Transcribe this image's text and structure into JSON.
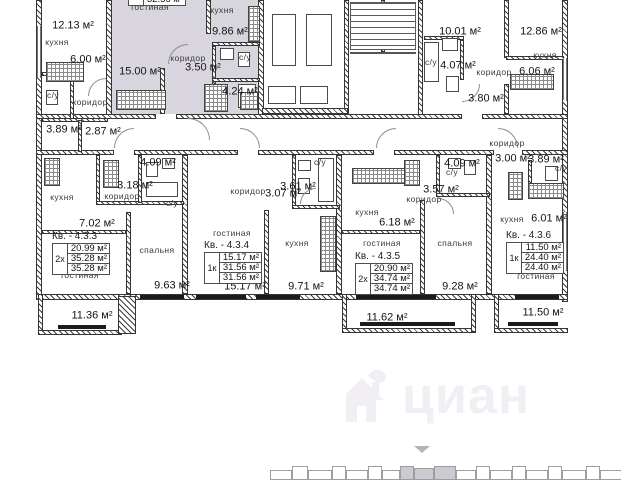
{
  "canvas": {
    "width": 621,
    "height": 480
  },
  "colors": {
    "highlight": "#d8d5de",
    "watermark": "#f1eff4",
    "wall": "#3d3d3d"
  },
  "watermark": {
    "brand": "циан"
  },
  "labels": [
    {
      "text": "12.13 м²",
      "x": 73,
      "y": 26,
      "cls": "ar"
    },
    {
      "text": "кухня",
      "x": 57,
      "y": 42,
      "cls": "rn"
    },
    {
      "text": "6.00 м²",
      "x": 88,
      "y": 60,
      "cls": "ar"
    },
    {
      "text": "с/у",
      "x": 53,
      "y": 95,
      "cls": "rn"
    },
    {
      "text": "коридор",
      "x": 90,
      "y": 102,
      "cls": "rn"
    },
    {
      "text": "3.89 м²",
      "x": 64,
      "y": 130,
      "cls": "ar"
    },
    {
      "text": "2.87 м²",
      "x": 103,
      "y": 132,
      "cls": "ar"
    },
    {
      "text": "гостиная",
      "x": 150,
      "y": 7,
      "cls": "rn"
    },
    {
      "text": "кухня",
      "x": 222,
      "y": 10,
      "cls": "rn"
    },
    {
      "text": "9.86 м²",
      "x": 230,
      "y": 32,
      "cls": "ar"
    },
    {
      "text": "с/у",
      "x": 245,
      "y": 57,
      "cls": "rn"
    },
    {
      "text": "коридор",
      "x": 188,
      "y": 58,
      "cls": "rn"
    },
    {
      "text": "3.50 м²",
      "x": 203,
      "y": 68,
      "cls": "ar"
    },
    {
      "text": "15.00 м²",
      "x": 140,
      "y": 72,
      "cls": "ar"
    },
    {
      "text": "4.24 м²",
      "x": 240,
      "y": 92,
      "cls": "ar"
    },
    {
      "text": "10.01 м²",
      "x": 460,
      "y": 32,
      "cls": "ar"
    },
    {
      "text": "12.86 м²",
      "x": 541,
      "y": 32,
      "cls": "ar"
    },
    {
      "text": "кухня",
      "x": 545,
      "y": 55,
      "cls": "rn"
    },
    {
      "text": "с/у",
      "x": 431,
      "y": 62,
      "cls": "rn"
    },
    {
      "text": "4.07 м²",
      "x": 458,
      "y": 66,
      "cls": "ar"
    },
    {
      "text": "коридор",
      "x": 494,
      "y": 72,
      "cls": "rn"
    },
    {
      "text": "6.06 м²",
      "x": 537,
      "y": 72,
      "cls": "ar"
    },
    {
      "text": "3.80 м²",
      "x": 486,
      "y": 99,
      "cls": "ar"
    },
    {
      "text": "коридор",
      "x": 507,
      "y": 143,
      "cls": "rn"
    },
    {
      "text": "3.00 м²",
      "x": 513,
      "y": 159,
      "cls": "ar"
    },
    {
      "text": "3.89 м²",
      "x": 546,
      "y": 160,
      "cls": "ar"
    },
    {
      "text": "с/у",
      "x": 561,
      "y": 168,
      "cls": "rn"
    },
    {
      "text": "кухня",
      "x": 512,
      "y": 219,
      "cls": "rn"
    },
    {
      "text": "6.01 м²",
      "x": 549,
      "y": 219,
      "cls": "ar"
    },
    {
      "text": "гостиная",
      "x": 536,
      "y": 276,
      "cls": "rn"
    },
    {
      "text": "11.50 м²",
      "x": 543,
      "y": 313,
      "cls": "ar"
    },
    {
      "text": "4.09 м²",
      "x": 158,
      "y": 163,
      "cls": "ar"
    },
    {
      "text": "3.18 м²",
      "x": 135,
      "y": 186,
      "cls": "ar"
    },
    {
      "text": "коридор",
      "x": 122,
      "y": 196,
      "cls": "rn"
    },
    {
      "text": "с/у",
      "x": 172,
      "y": 203,
      "cls": "rn"
    },
    {
      "text": "кухня",
      "x": 62,
      "y": 197,
      "cls": "rn"
    },
    {
      "text": "7.02 м²",
      "x": 97,
      "y": 224,
      "cls": "ar"
    },
    {
      "text": "гостиная",
      "x": 80,
      "y": 275,
      "cls": "rn"
    },
    {
      "text": "спальня",
      "x": 157,
      "y": 250,
      "cls": "rn"
    },
    {
      "text": "9.63 м²",
      "x": 172,
      "y": 286,
      "cls": "ar"
    },
    {
      "text": "11.36 м²",
      "x": 92,
      "y": 316,
      "cls": "ar"
    },
    {
      "text": "коридор",
      "x": 248,
      "y": 191,
      "cls": "rn"
    },
    {
      "text": "3.07 м²",
      "x": 283,
      "y": 194,
      "cls": "ar"
    },
    {
      "text": "3.61 м²",
      "x": 298,
      "y": 187,
      "cls": "ar"
    },
    {
      "text": "с/у",
      "x": 320,
      "y": 162,
      "cls": "rn"
    },
    {
      "text": "гостиная",
      "x": 232,
      "y": 233,
      "cls": "rn"
    },
    {
      "text": "кухня",
      "x": 297,
      "y": 243,
      "cls": "rn"
    },
    {
      "text": "15.17 м²",
      "x": 245,
      "y": 287,
      "cls": "ar"
    },
    {
      "text": "9.71 м²",
      "x": 306,
      "y": 287,
      "cls": "ar"
    },
    {
      "text": "4.09 м²",
      "x": 462,
      "y": 164,
      "cls": "ar"
    },
    {
      "text": "с/у",
      "x": 452,
      "y": 172,
      "cls": "rn"
    },
    {
      "text": "3.57 м²",
      "x": 441,
      "y": 190,
      "cls": "ar"
    },
    {
      "text": "коридор",
      "x": 424,
      "y": 199,
      "cls": "rn"
    },
    {
      "text": "кухня",
      "x": 367,
      "y": 212,
      "cls": "rn"
    },
    {
      "text": "6.18 м²",
      "x": 397,
      "y": 223,
      "cls": "ar"
    },
    {
      "text": "гостиная",
      "x": 382,
      "y": 243,
      "cls": "rn"
    },
    {
      "text": "спальня",
      "x": 455,
      "y": 243,
      "cls": "rn"
    },
    {
      "text": "9.28 м²",
      "x": 460,
      "y": 287,
      "cls": "ar"
    },
    {
      "text": "11.62 м²",
      "x": 387,
      "y": 318,
      "cls": "ar"
    }
  ],
  "apartment_tables": [
    {
      "name": "apt-4-3-top-partial",
      "title": "",
      "code": "",
      "rows": [
        "",
        "",
        "32.56 м²"
      ],
      "x": 128,
      "y": -26
    },
    {
      "name": "apt-4-3-3",
      "title": "Кв. - 4.3.3",
      "code": "2х",
      "rows": [
        "20.99 м²",
        "35.28 м²",
        "35.28 м²"
      ],
      "x": 52,
      "y": 243
    },
    {
      "name": "apt-4-3-4",
      "title": "Кв. - 4.3.4",
      "code": "1к",
      "rows": [
        "15.17 м²",
        "31.56 м²",
        "31.56 м²"
      ],
      "x": 204,
      "y": 252
    },
    {
      "name": "apt-4-3-5",
      "title": "Кв. - 4.3.5",
      "code": "2х",
      "rows": [
        "20.90 м²",
        "34.74 м²",
        "34.74 м²"
      ],
      "x": 355,
      "y": 263
    },
    {
      "name": "apt-4-3-6",
      "title": "Кв. - 4.3.6",
      "code": "1к",
      "rows": [
        "11.50 м²",
        "24.40 м²",
        "24.40 м²"
      ],
      "x": 506,
      "y": 242
    }
  ]
}
